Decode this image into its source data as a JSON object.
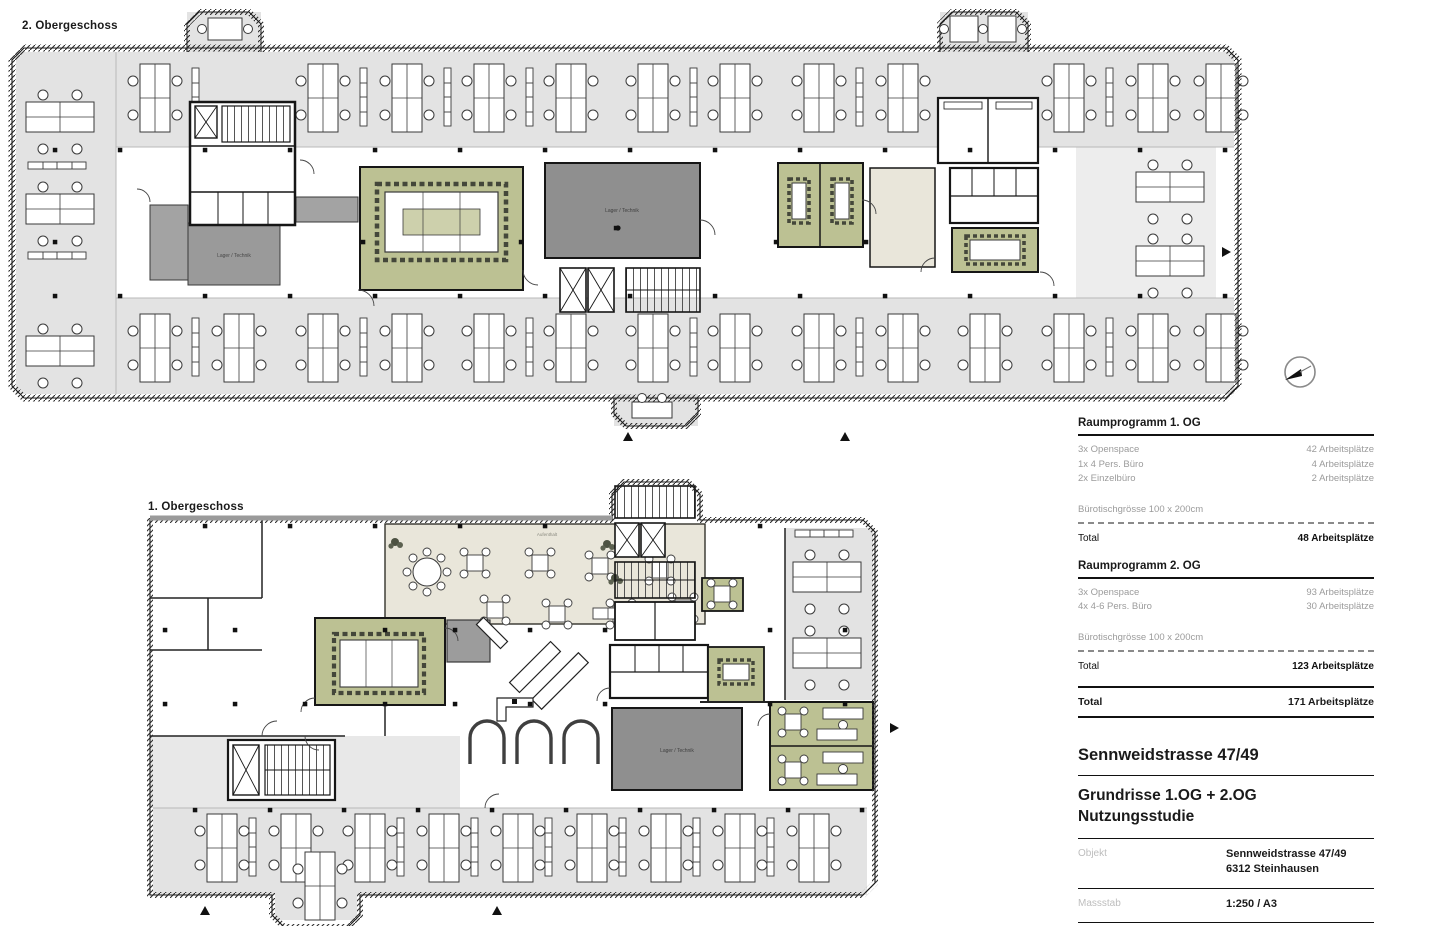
{
  "sheet": {
    "plan_upper_label": "2. Obergeschoss",
    "plan_lower_label": "1. Obergeschoss"
  },
  "room_labels": {
    "storage": "Lager / Technik",
    "lounge": "Aufenthalt"
  },
  "program": {
    "sections": [
      {
        "title": "Raumprogramm 1. OG",
        "rows": [
          [
            "3x Openspace",
            "42 Arbeitsplätze"
          ],
          [
            "1x 4 Pers. Büro",
            "4 Arbeitsplätze"
          ],
          [
            "2x Einzelbüro",
            "2 Arbeitsplätze"
          ]
        ],
        "note": "Bürotischgrösse 100 x 200cm",
        "total_label": "Total",
        "total_value": "48 Arbeitsplätze"
      },
      {
        "title": "Raumprogramm 2. OG",
        "rows": [
          [
            "3x Openspace",
            "93 Arbeitsplätze"
          ],
          [
            "4x 4-6 Pers. Büro",
            "30 Arbeitsplätze"
          ]
        ],
        "note": "Bürotischgrösse 100 x 200cm",
        "total_label": "Total",
        "total_value": "123 Arbeitsplätze"
      }
    ],
    "grand_total_label": "Total",
    "grand_total_value": "171 Arbeitsplätze"
  },
  "title_block": {
    "project": "Sennweidstrasse 47/49",
    "drawing_line1": "Grundrisse 1.OG + 2.OG",
    "drawing_line2": "Nutzungsstudie",
    "object_label": "Objekt",
    "object_line1": "Sennweidstrasse 47/49",
    "object_line2": "6312 Steinhausen",
    "scale_label": "Massstab",
    "scale_value": "1:250 / A3"
  },
  "colors": {
    "openspace_gray": "#e3e3e3",
    "meeting_green": "#bcc193",
    "storage_dark": "#8f8f8f",
    "storage_mid": "#a3a3a3",
    "lounge_beige": "#e9e6da",
    "wall_black": "#1c1c1c"
  }
}
